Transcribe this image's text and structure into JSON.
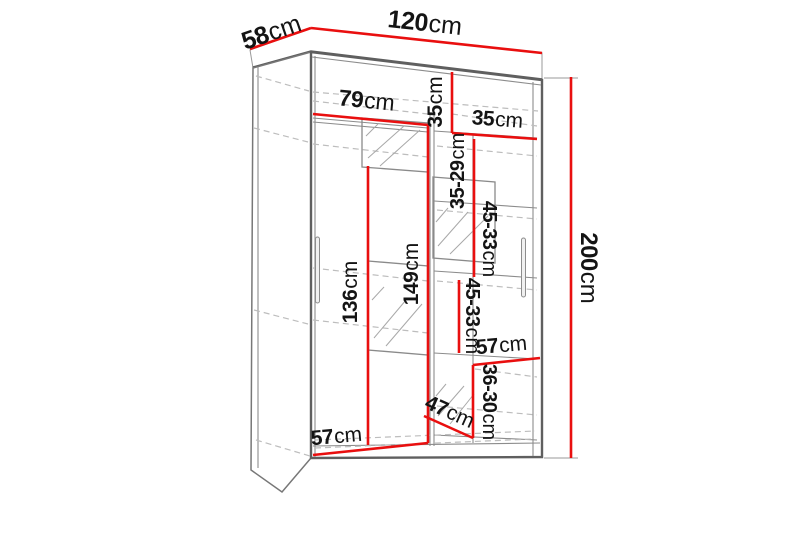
{
  "diagram": {
    "title": "wardrobe-dimension-diagram",
    "unit": "cm",
    "colors": {
      "dimension_line": "#e90f0f",
      "outline": "#5f5f5f",
      "dashed": "#bdbdbd",
      "label_text": "#141414"
    },
    "dimensions": {
      "depth_top": {
        "num": "58",
        "unit": "cm"
      },
      "width_top": {
        "num": "120",
        "unit": "cm"
      },
      "height_right": {
        "num": "200",
        "unit": "cm"
      },
      "left_section_width": {
        "num": "79",
        "unit": "cm"
      },
      "top_shelf_height": {
        "num": "35",
        "unit": "cm"
      },
      "right_shelf_width": {
        "num": "35",
        "unit": "cm"
      },
      "shelf_gap_upper": {
        "num": "35-29",
        "unit": "cm"
      },
      "shelf_gap_mid": {
        "num": "45-33",
        "unit": "cm"
      },
      "shelf_gap_lower": {
        "num": "45-33",
        "unit": "cm"
      },
      "mirror_height": {
        "num": "136",
        "unit": "cm"
      },
      "hanging_height": {
        "num": "149",
        "unit": "cm"
      },
      "right_width_lower": {
        "num": "57",
        "unit": "cm"
      },
      "bottom_gap": {
        "num": "36-30",
        "unit": "cm"
      },
      "bottom_shelf_width": {
        "num": "47",
        "unit": "cm"
      },
      "left_width_bottom": {
        "num": "57",
        "unit": "cm"
      }
    }
  }
}
